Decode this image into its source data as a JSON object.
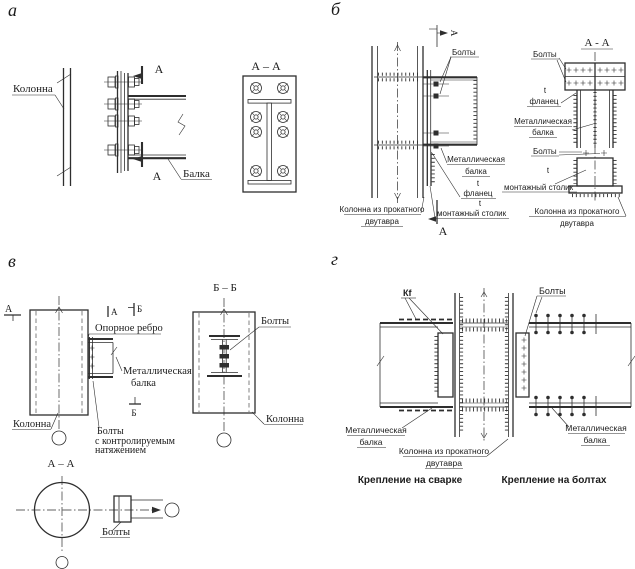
{
  "page": {
    "background": "#ffffff",
    "ink_color": "#2e2e2e"
  },
  "panel_a": {
    "tag": "а",
    "column": "Колонна",
    "beam": "Балка",
    "mark": "А",
    "section_title": "А – А"
  },
  "panel_b": {
    "tag": "б",
    "bolts": "Болты",
    "mark": "А",
    "section_title": "А - А",
    "metal_beam_1": "Металлическая",
    "metal_beam_2": "балка",
    "t": "t",
    "flange": "фланец",
    "mount_table": "монтажный столик",
    "column_1": "Колонна из прокатного",
    "column_2": "двутавра"
  },
  "panel_v": {
    "tag": "в",
    "mark_a": "А",
    "mark_b": "Б",
    "section_bb": "Б – Б",
    "section_aa": "А – А",
    "support_rib": "Опорное ребро",
    "metal_beam_1": "Металлическая",
    "metal_beam_2": "балка",
    "column": "Колонна",
    "bolts": "Болты",
    "bolts_ctrl_1": "Болты",
    "bolts_ctrl_2": "с контролируемым",
    "bolts_ctrl_3": "натяжением"
  },
  "panel_g": {
    "tag": "г",
    "weld_mark": "Кf",
    "bolts": "Болты",
    "metal_beam_1": "Металлическая",
    "metal_beam_2": "балка",
    "column_1": "Колонна из прокатного",
    "column_2": "двутавра",
    "caption_weld": "Крепление на сварке",
    "caption_bolts": "Крепление на болтах"
  }
}
